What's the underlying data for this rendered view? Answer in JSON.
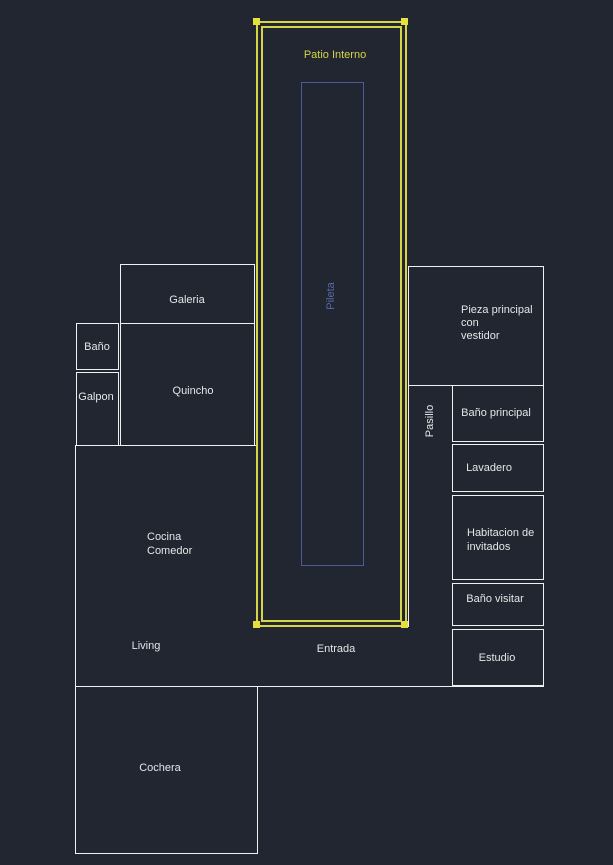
{
  "drawing": {
    "type": "floor-plan",
    "style": "cad-dark"
  },
  "colors": {
    "background": "#212630",
    "wall": "#eef0f2",
    "text": "#e4e6e8",
    "patio": "#d6d54a",
    "grip": "#e6df3c",
    "pool": "#4d5c97",
    "pool_text": "#5a69a8"
  },
  "labels": {
    "patio_interno": "Patio Interno",
    "pileta": "Pileta",
    "galeria": "Galeria",
    "bano": "Baño",
    "galpon": "Galpon",
    "quincho": "Quincho",
    "cocina_1": "Cocina",
    "cocina_2": "Comedor",
    "living": "Living",
    "entrada": "Entrada",
    "cochera": "Cochera",
    "pieza_1": "Pieza principal",
    "pieza_2": "con",
    "pieza_3": "vestidor",
    "pasillo": "Pasillo",
    "bano_principal": "Baño principal",
    "lavadero": "Lavadero",
    "habitacion_1": "Habitacion de",
    "habitacion_2": "invitados",
    "bano_visitar": "Baño visitar",
    "estudio": "Estudio"
  }
}
